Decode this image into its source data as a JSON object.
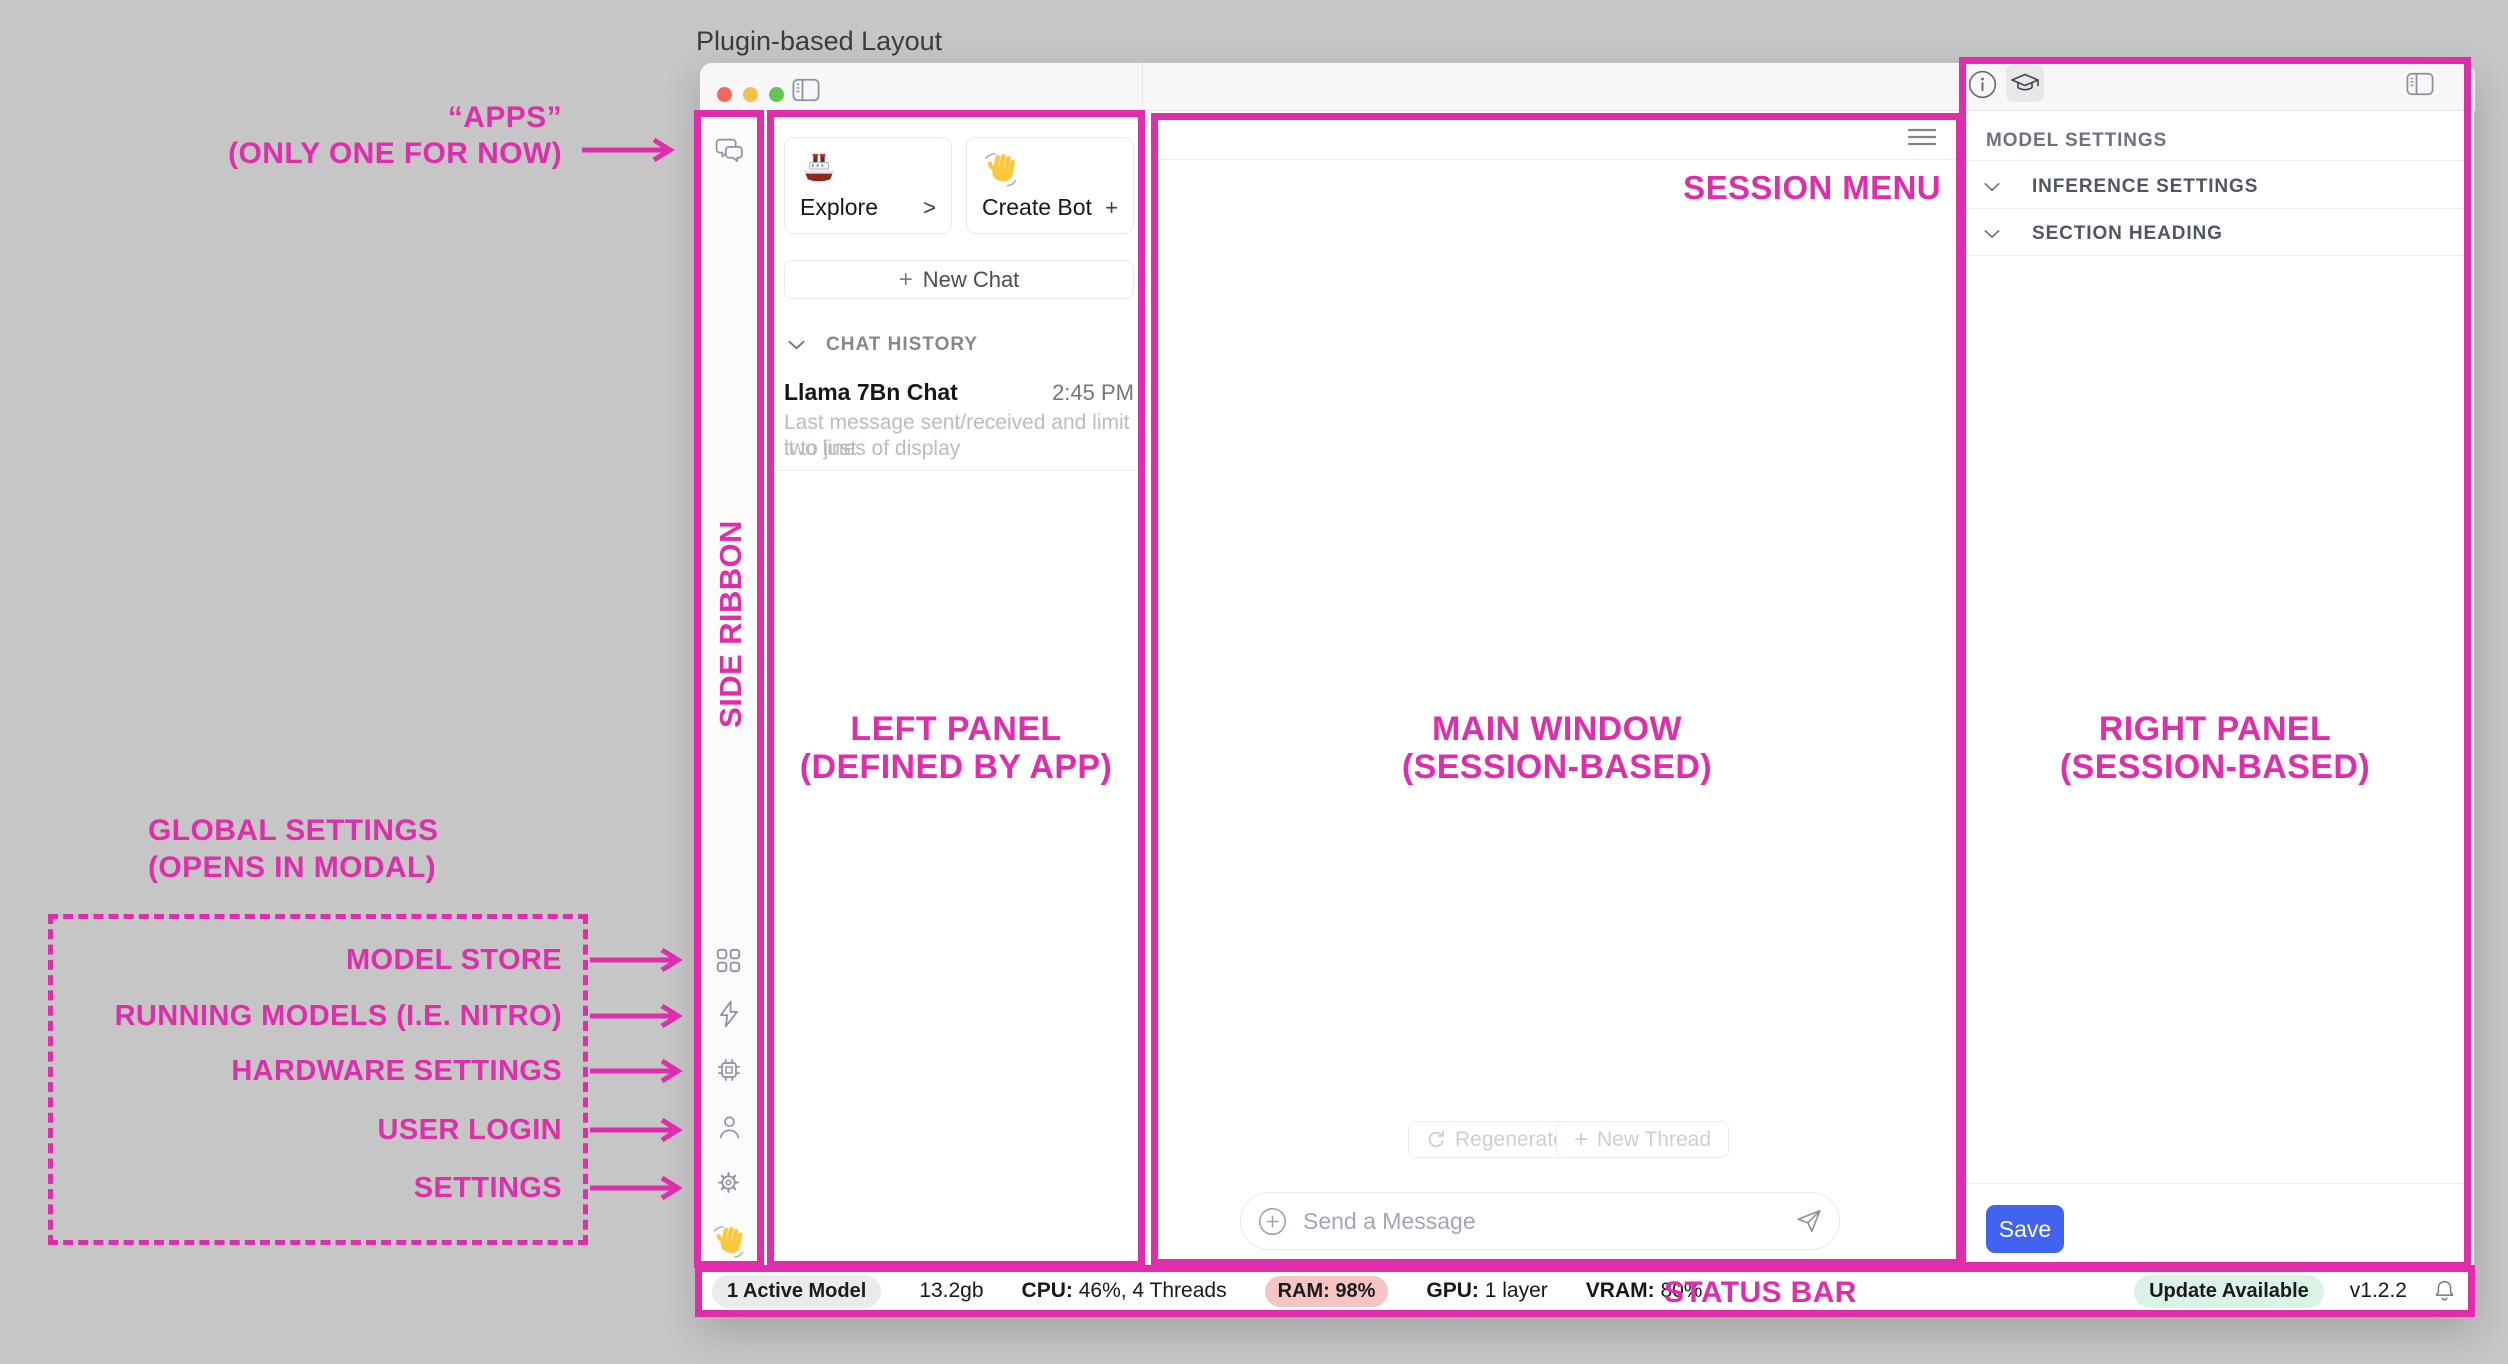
{
  "header": {
    "title": "Plugin-based Layout"
  },
  "colors": {
    "magenta": "#df2dac",
    "save_blue": "#4263f0",
    "ram_badge_bg": "#f4c5c3",
    "update_badge_bg": "#dbf2e6",
    "traffic_red": "#ee6a5e",
    "traffic_yellow": "#f5bf4f",
    "traffic_green": "#62c554"
  },
  "icons": [
    "chat-bubbles-icon",
    "grid-icon",
    "bolt-icon",
    "chip-icon",
    "person-icon",
    "gear-icon",
    "ship-emoji",
    "wave-emoji",
    "sidebar-toggle-icon",
    "info-icon",
    "graduation-cap-icon",
    "hamburger-icon",
    "refresh-icon",
    "plus-icon",
    "circled-plus-icon",
    "send-icon",
    "bell-icon",
    "chevron-down-icon"
  ],
  "annotations": {
    "apps_line1": "“APPS”",
    "apps_line2": "(ONLY ONE FOR NOW)",
    "side_ribbon": "SIDE RIBBON",
    "left_panel_line1": "LEFT PANEL",
    "left_panel_line2": "(DEFINED BY APP)",
    "main_window_line1": "MAIN WINDOW",
    "main_window_line2": "(SESSION-BASED)",
    "right_panel_line1": "RIGHT PANEL",
    "right_panel_line2": "(SESSION-BASED)",
    "session_menu": "SESSION MENU",
    "status_bar": "STATUS BAR",
    "global_settings_line1": "GLOBAL SETTINGS",
    "global_settings_line2": "(OPENS IN MODAL)",
    "ribbon_targets": [
      "MODEL STORE",
      "RUNNING MODELS (I.E. NITRO)",
      "HARDWARE SETTINGS",
      "USER LOGIN",
      "SETTINGS"
    ]
  },
  "left_panel": {
    "explore_label": "Explore",
    "explore_affordance": ">",
    "create_bot_label": "Create Bot",
    "create_bot_affordance": "+",
    "new_chat_plus": "+",
    "new_chat_label": "New Chat",
    "chat_history_header": "CHAT HISTORY",
    "chat_item": {
      "title": "Llama 7Bn Chat",
      "time": "2:45 PM",
      "preview_line1": "Last message sent/received and limit it to just",
      "preview_line2": "two lines of display"
    }
  },
  "main": {
    "regenerate_label": "Regenerate",
    "new_thread_plus": "+",
    "new_thread_label": "New Thread",
    "message_placeholder": "Send a Message"
  },
  "right_panel": {
    "header": "MODEL SETTINGS",
    "sections": [
      "INFERENCE SETTINGS",
      "SECTION HEADING"
    ],
    "save_label": "Save"
  },
  "status_bar": {
    "active_model": "1 Active Model",
    "size": "13.2gb",
    "cpu_label": "CPU:",
    "cpu_value": " 46%, 4 Threads",
    "ram_label": "RAM:",
    "ram_value": " 98%",
    "gpu_label": "GPU:",
    "gpu_value": " 1 layer",
    "vram_label": "VRAM:",
    "vram_value": " 80%",
    "update_badge": "Update Available",
    "version": "v1.2.2"
  }
}
